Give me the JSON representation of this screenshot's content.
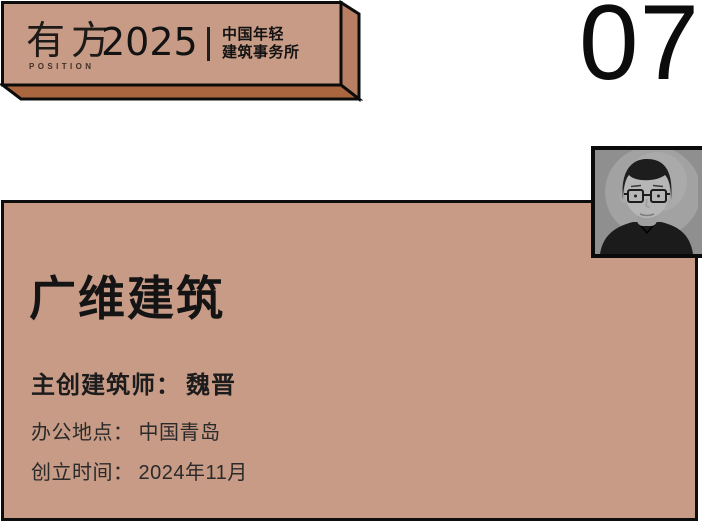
{
  "banner": {
    "logo_chinese": "有方",
    "logo_english": "POSITION",
    "year": "2025",
    "subtitle_line1": "中国年轻",
    "subtitle_line2": "建筑事务所"
  },
  "index_number": "07",
  "card": {
    "firm_name": "广维建筑",
    "fields": [
      {
        "label": "主创建筑师：",
        "value": "魏晋"
      },
      {
        "label": "办公地点：",
        "value": "中国青岛"
      },
      {
        "label": "创立时间：",
        "value": "2024年11月"
      }
    ]
  },
  "colors": {
    "salmon": "#c79b86",
    "salmon_side": "#b97f64",
    "salmon_bottom": "#a9663f",
    "ink": "#121212",
    "body_text": "#2a2a2a",
    "background": "#ffffff",
    "photo_bg": "#8f8f8f",
    "photo_face": "#b6b6b6",
    "photo_dark": "#1b1b1b"
  }
}
